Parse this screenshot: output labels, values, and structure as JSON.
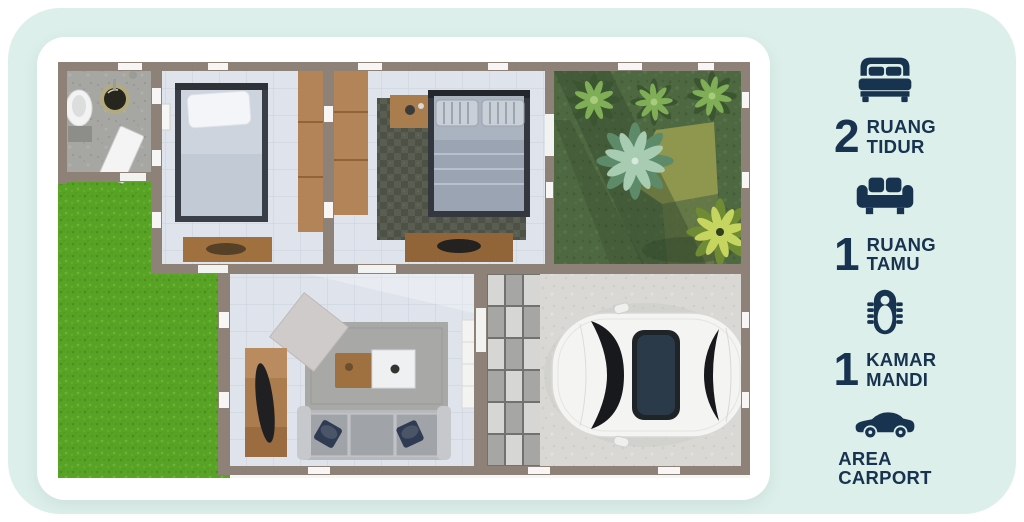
{
  "theme": {
    "panel_bg": "#ddefea",
    "card_bg": "#ffffff",
    "accent_navy": "#17334f",
    "grass_green": "#58a226",
    "garden_green": "#4e6941",
    "wall_taupe": "#8e8177",
    "wood": "#b28457"
  },
  "floor_plan": {
    "description": "top-down 3D render of a small house",
    "areas": [
      "bathroom",
      "bedroom-1",
      "bedroom-2",
      "side-garden",
      "grass-yard",
      "living-room",
      "paver-path",
      "carport",
      "car"
    ]
  },
  "sidebar": {
    "items": [
      {
        "icon": "bed-icon",
        "count": "2",
        "lines": [
          "RUANG",
          "TIDUR"
        ]
      },
      {
        "icon": "sofa-icon",
        "count": "1",
        "lines": [
          "RUANG",
          "TAMU"
        ]
      },
      {
        "icon": "bathtub-icon",
        "count": "1",
        "lines": [
          "KAMAR",
          "MANDI"
        ]
      },
      {
        "icon": "car-icon",
        "count": "",
        "lines": [
          "AREA",
          "CARPORT"
        ]
      }
    ]
  }
}
